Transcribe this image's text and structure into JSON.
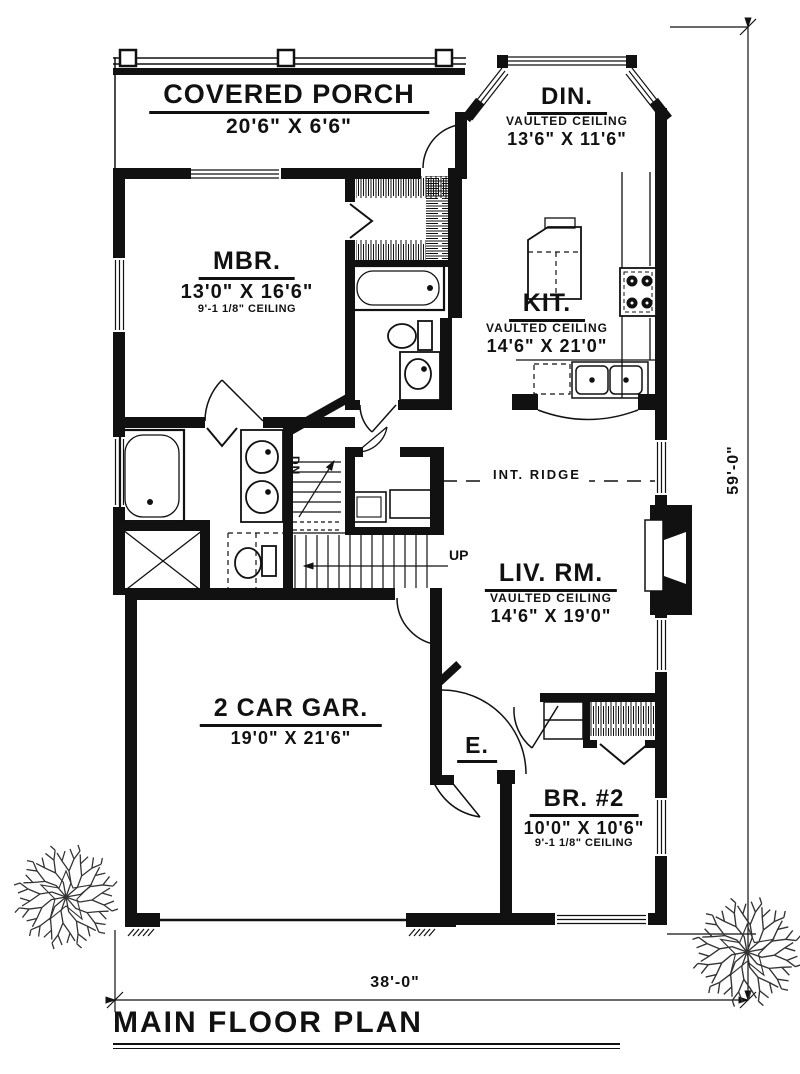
{
  "plan": {
    "title": "MAIN FLOOR PLAN",
    "overall_width": "38'-0\"",
    "overall_height": "59'-0\"",
    "ridge_label": "INT. RIDGE",
    "stairs_up": "UP",
    "stairs_down": "DN"
  },
  "rooms": {
    "porch": {
      "name": "COVERED PORCH",
      "size": "20'6\" X 6'6\""
    },
    "dining": {
      "name": "DIN.",
      "ceiling": "VAULTED CEILING",
      "size": "13'6\" X 11'6\""
    },
    "master": {
      "name": "MBR.",
      "size": "13'0\" X 16'6\"",
      "ceiling": "9'-1 1/8\" CEILING"
    },
    "kitchen": {
      "name": "KIT.",
      "ceiling": "VAULTED CEILING",
      "size": "14'6\" X 21'0\""
    },
    "living": {
      "name": "LIV. RM.",
      "ceiling": "VAULTED CEILING",
      "size": "14'6\" X 19'0\""
    },
    "garage": {
      "name": "2 CAR GAR.",
      "size": "19'0\" X 21'6\""
    },
    "entry": {
      "name": "E."
    },
    "bedroom2": {
      "name": "BR. #2",
      "size": "10'0\" X 10'6\"",
      "ceiling": "9'-1 1/8\" CEILING"
    }
  },
  "colors": {
    "ink": "#111111",
    "paper": "#ffffff"
  }
}
